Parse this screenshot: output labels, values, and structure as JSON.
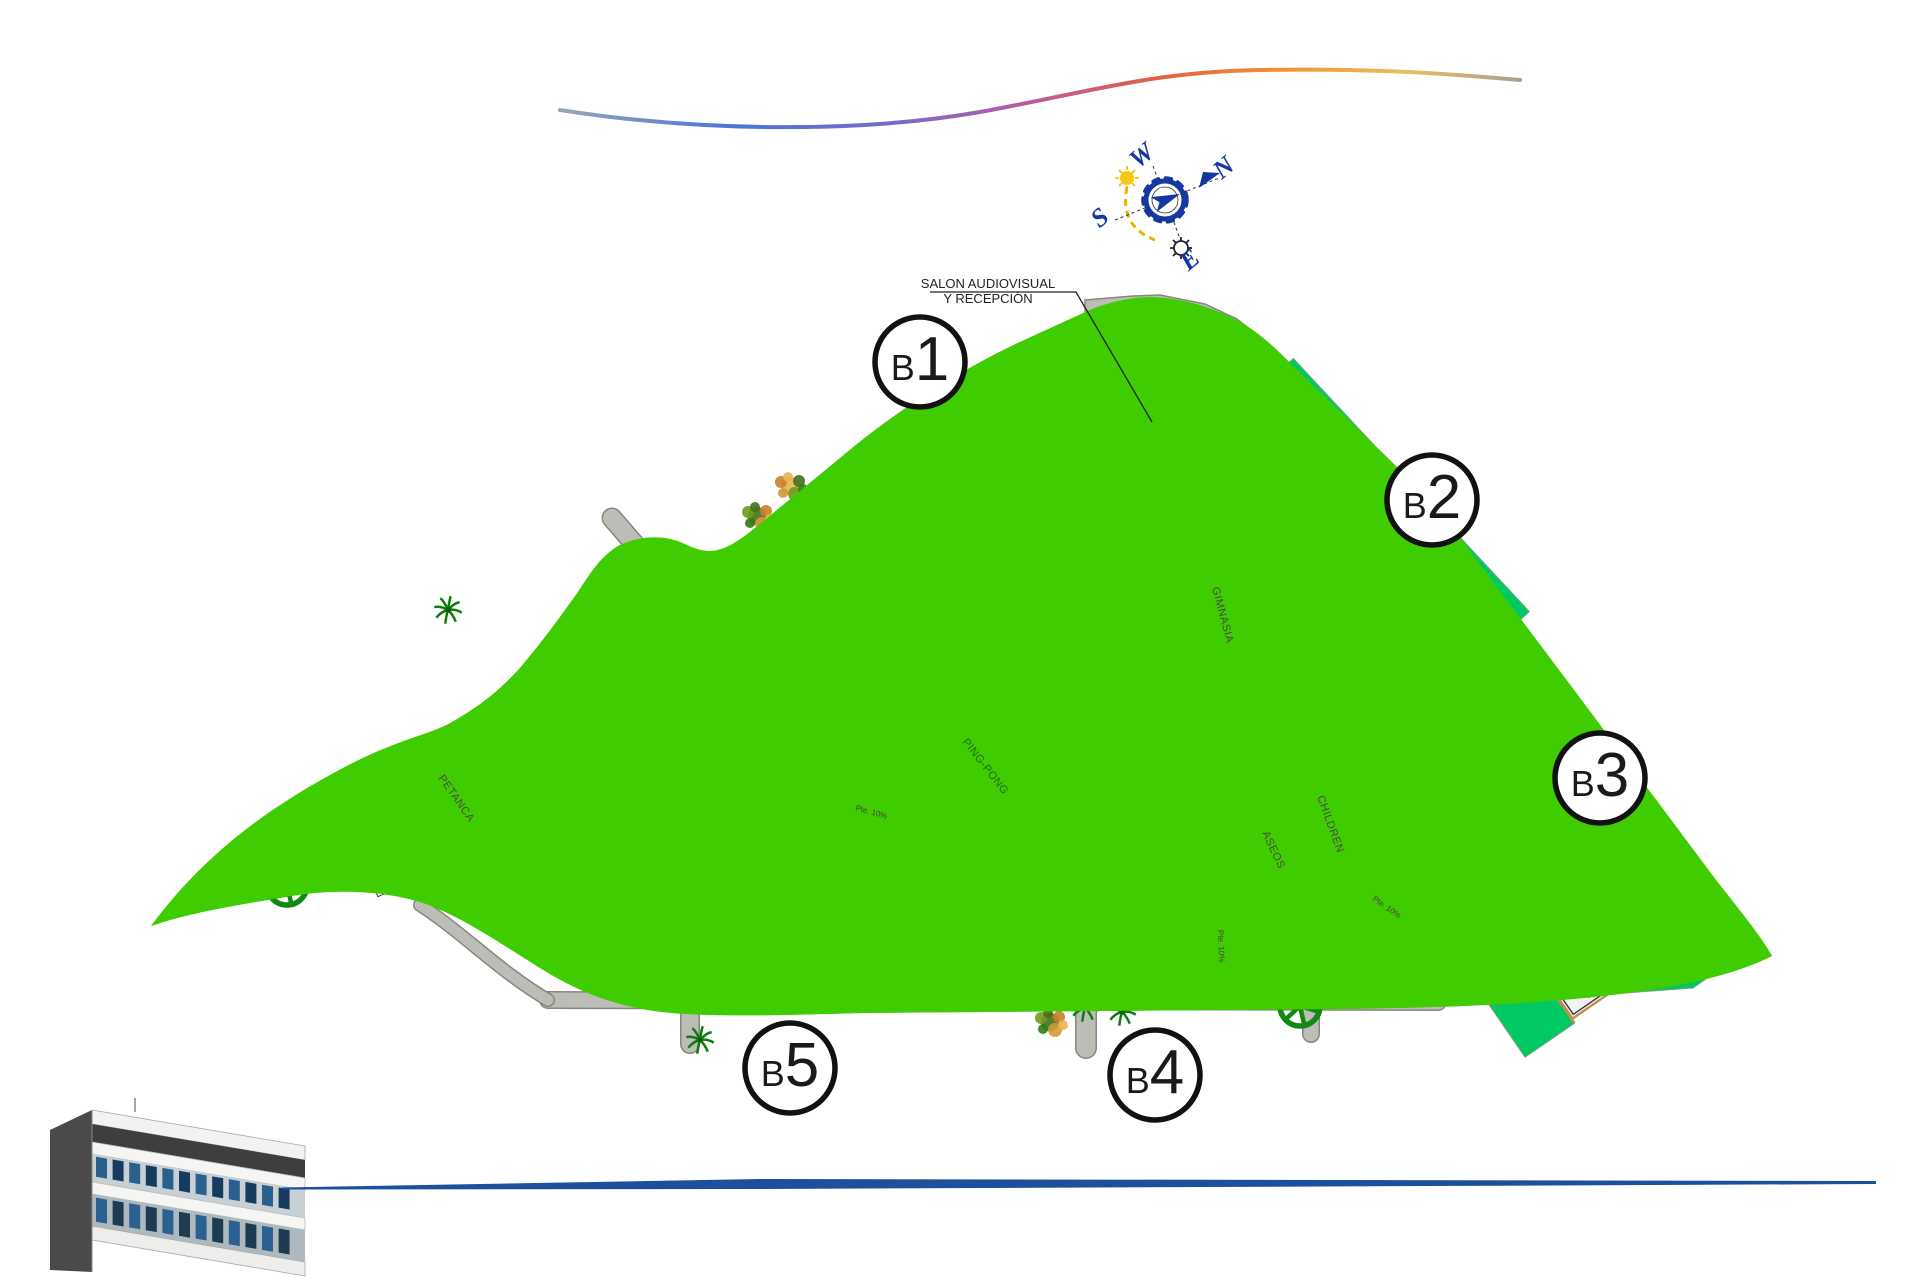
{
  "annotation": {
    "line1": "SALON AUDIOVISUAL",
    "line2": "Y RECEPCIÓN"
  },
  "compass": {
    "n": "N",
    "w": "W",
    "s": "S",
    "e": "E"
  },
  "blocks": [
    {
      "id": "B1",
      "badge_b": "B",
      "badge_num": "1",
      "units": [
        [
          "01",
          "02",
          "03"
        ],
        [
          "04",
          "05",
          "06"
        ],
        [
          "07",
          "08",
          "09"
        ],
        [
          "10",
          "11",
          "12"
        ],
        [
          "13",
          "14",
          "15"
        ],
        [
          "16",
          "17",
          "18"
        ],
        [
          "19",
          "20",
          "21"
        ]
      ]
    },
    {
      "id": "B2",
      "badge_b": "B",
      "badge_num": "2",
      "units": [
        [
          "22",
          "23",
          "24"
        ],
        [
          "25",
          "26",
          "27"
        ],
        [
          "28",
          "29",
          "30"
        ],
        [
          "31",
          "32",
          "33"
        ],
        [
          "34",
          "35",
          "36"
        ],
        [
          "37",
          "38",
          "39"
        ],
        [
          "40",
          "41",
          "42"
        ]
      ]
    },
    {
      "id": "B3",
      "badge_b": "B",
      "badge_num": "3",
      "units": [
        [
          "43",
          "44",
          "45"
        ],
        [
          "46",
          "47",
          "48"
        ],
        [
          "49",
          "50",
          "51"
        ],
        [
          "52",
          "53",
          "54"
        ],
        [
          "55",
          "56",
          "57"
        ],
        [
          "58",
          "59",
          "60"
        ],
        [
          "61",
          "62",
          "63"
        ]
      ]
    },
    {
      "id": "B4",
      "badge_b": "B",
      "badge_num": "4",
      "units": [
        [
          "84",
          "83",
          "82"
        ],
        [
          "81",
          "80",
          "79"
        ],
        [
          "78",
          "77",
          "76"
        ],
        [
          "75",
          "74",
          "73"
        ],
        [
          "72",
          "71",
          "70"
        ],
        [
          "69",
          "68",
          "67"
        ],
        [
          "66",
          "65",
          "64"
        ]
      ]
    },
    {
      "id": "B5",
      "badge_b": "B",
      "badge_num": "5",
      "units": [
        [
          "108",
          "107",
          "106"
        ],
        [
          "105",
          "104",
          "103"
        ],
        [
          "102",
          "101",
          "100"
        ],
        [
          "99",
          "98",
          "97"
        ],
        [
          "96",
          "95",
          "94"
        ],
        [
          "93",
          "92",
          "91"
        ],
        [
          "90",
          "89",
          "88"
        ],
        [
          "87",
          "86",
          "85"
        ]
      ]
    }
  ],
  "facilities": {
    "petanca": {
      "label": "PETANCA"
    },
    "gimnasia": {
      "label": "GIMNASIA"
    },
    "pingpong": {
      "label": "PING-PONG"
    },
    "children": {
      "label": "CHILDREN"
    },
    "aseos": {
      "label": "ASEOS"
    }
  },
  "micro_labels": [
    "Pte. 10%",
    "Pte. 10%",
    "Pte. 10%"
  ],
  "colors": {
    "lawn": "#3FCC00",
    "parcel": "#00C964",
    "road": "#BDBDB8",
    "road_edge": "#87877F",
    "boundary": "#C81EC8",
    "unit_number": "#3B3BCC",
    "pool_water": "#8A8AE8",
    "pool_deck": "#F2CE80",
    "tree": "#118A11",
    "swoosh_blue": "#4A74D8",
    "swoosh_orange": "#F09038",
    "bottom_line": "#1C4F9C",
    "badge_text": "#1A1A1A",
    "compass_blue": "#16379E"
  }
}
